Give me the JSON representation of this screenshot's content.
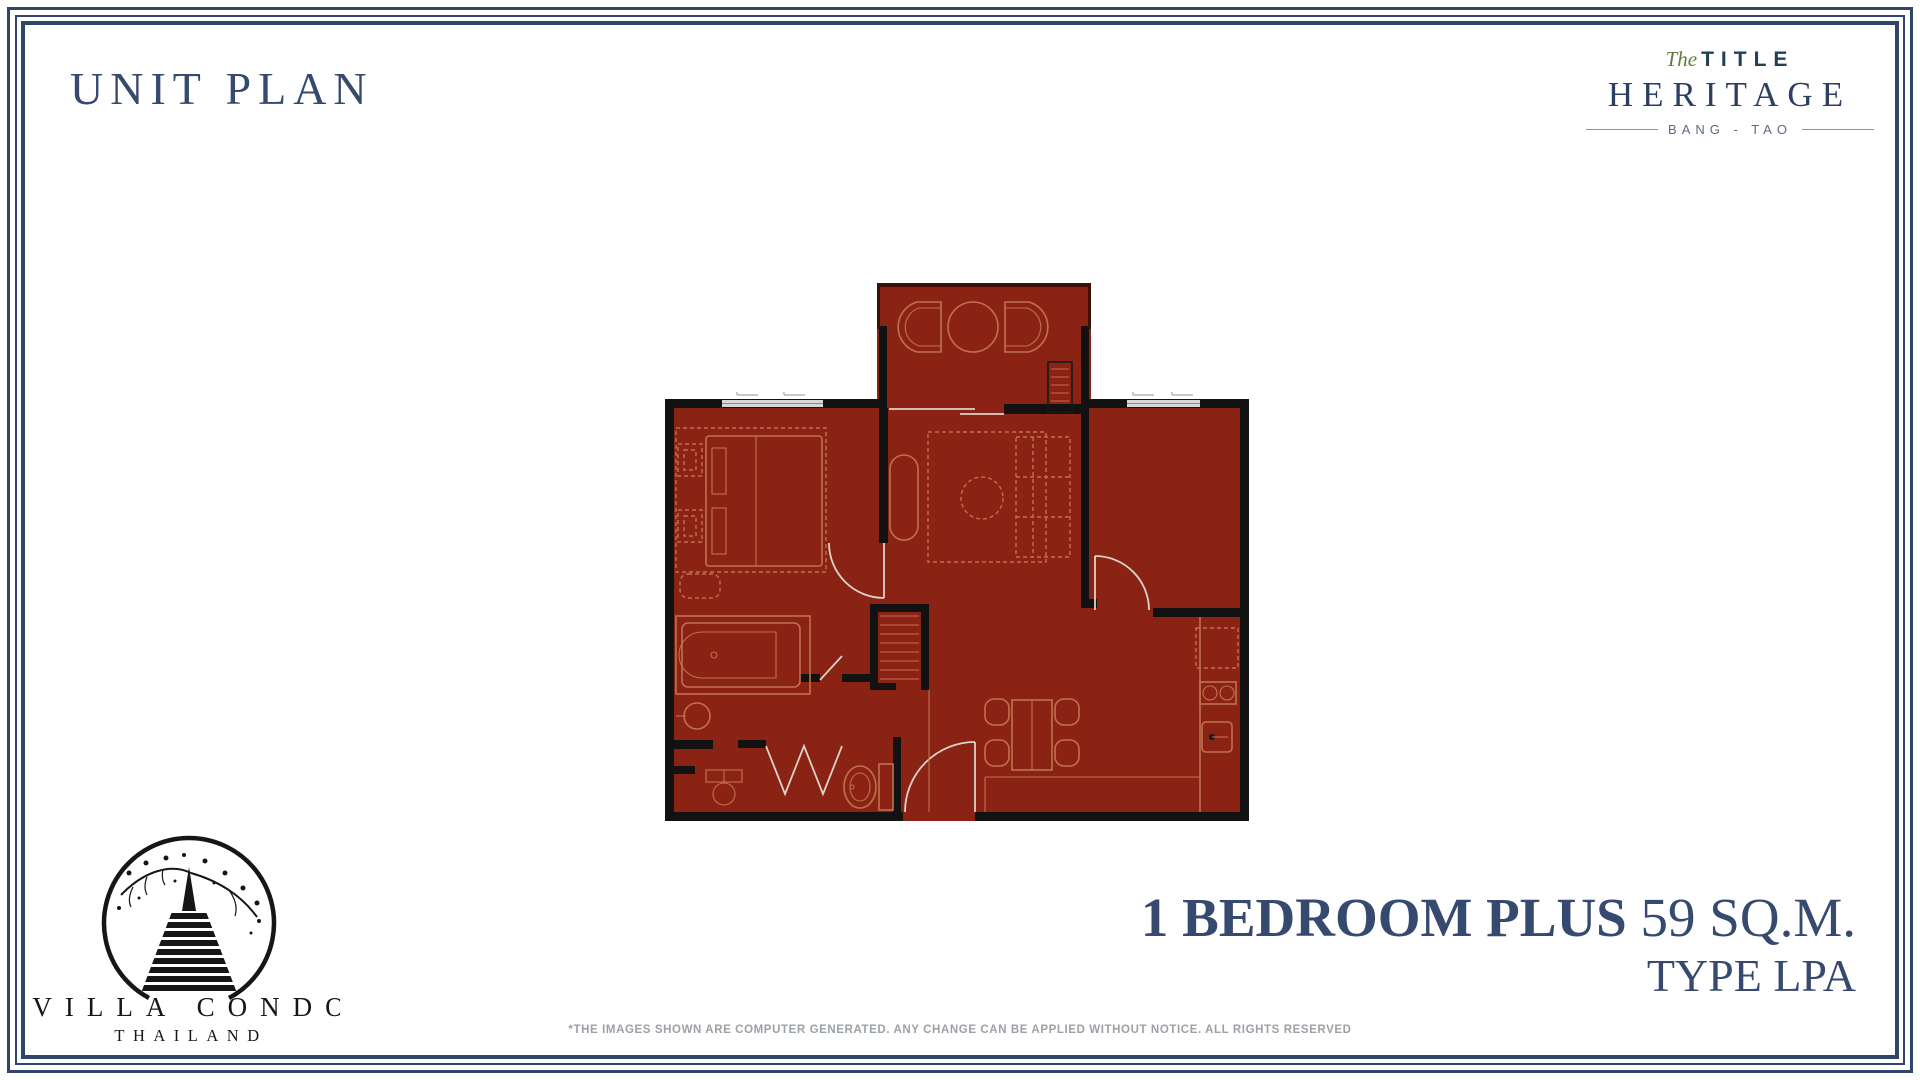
{
  "page": {
    "title": "UNIT PLAN"
  },
  "brand": {
    "pre": "The",
    "name": "TITLE",
    "sub": "HERITAGE",
    "location": "BANG - TAO"
  },
  "developer": {
    "name": "VILLA CONDO",
    "country": "THAILAND"
  },
  "unit": {
    "name": "1 BEDROOM PLUS",
    "area": "59 SQ.M.",
    "type": "TYPE LPA"
  },
  "disclaimer": "*THE IMAGES SHOWN ARE COMPUTER GENERATED. ANY CHANGE CAN BE APPLIED WITHOUT NOTICE. ALL RIGHTS RESERVED",
  "plan": {
    "rooms": [
      "balcony",
      "bedroom",
      "living-room",
      "plus-room",
      "bathroom",
      "kitchen-dining",
      "entrance"
    ]
  },
  "colors": {
    "navy": "#36496F",
    "heritage": "#2C3F63",
    "frame": "#2F4569",
    "green": "#5F7D3F",
    "gray": "#9BA1A7",
    "plan-red": "#8A2313",
    "wall": "#121212",
    "furn": "#C0714E",
    "window": "#D8D8D8",
    "lt": "#DCD2C9",
    "black": "#1A1A1A"
  }
}
